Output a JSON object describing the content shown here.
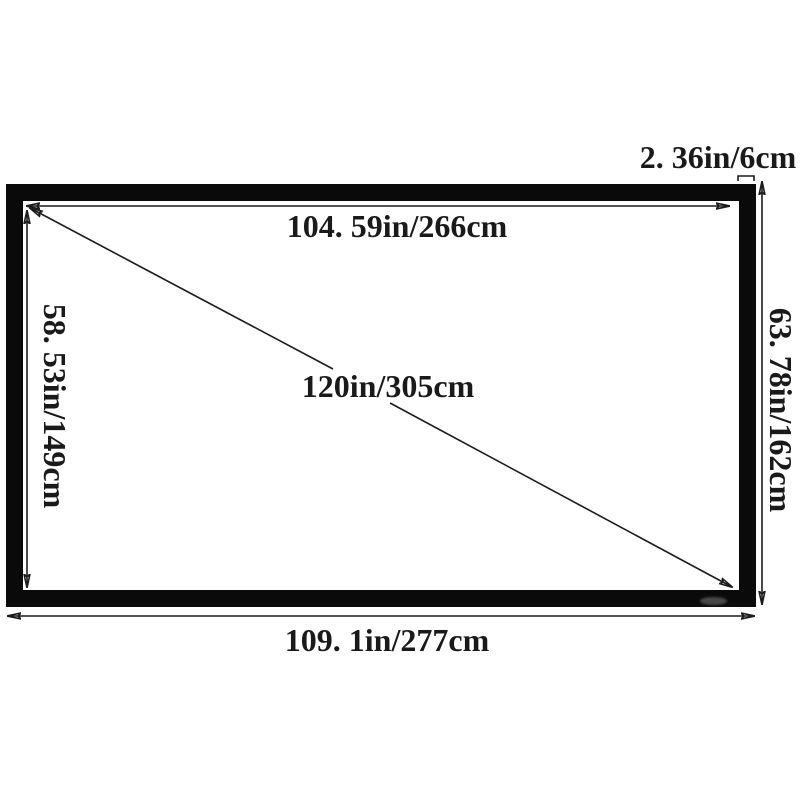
{
  "diagram": {
    "labels": {
      "frame_thickness": "2. 36in/6cm",
      "viewing_width": "104. 59in/266cm",
      "diagonal": "120in/305cm",
      "viewing_height": "58. 53in/149cm",
      "overall_height": "63. 78in/162cm",
      "overall_width": "109. 1in/277cm"
    },
    "colors": {
      "background": "#ffffff",
      "frame": "#0a0a0a",
      "dimension_line": "#1c1c1c",
      "text": "#1a1a1a",
      "logo": "#7a7a7a"
    }
  }
}
